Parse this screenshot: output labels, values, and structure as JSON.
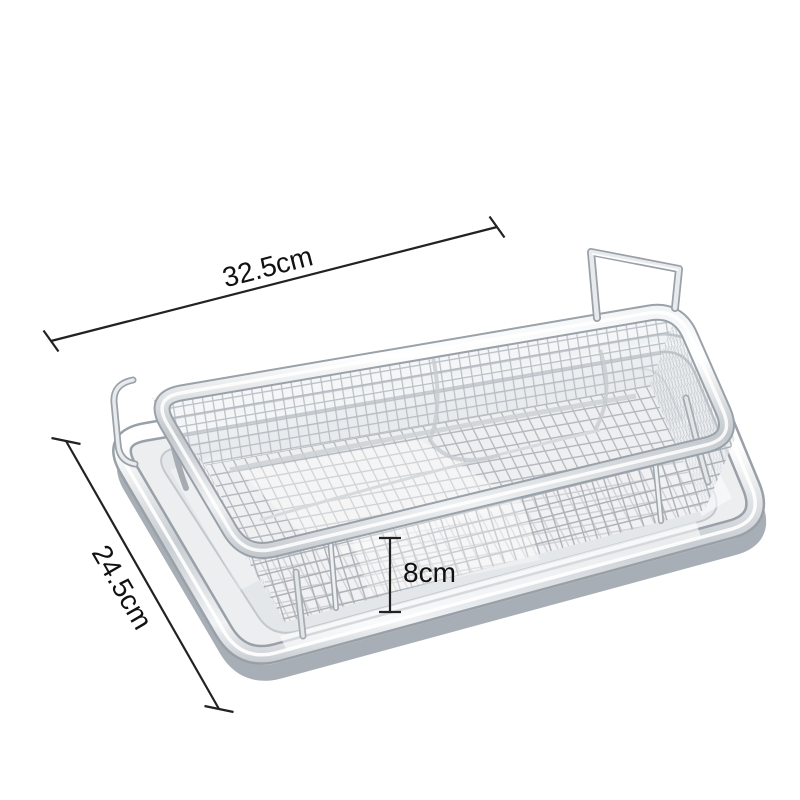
{
  "dimensions": {
    "width": "32.5cm",
    "depth": "24.5cm",
    "height": "8cm"
  },
  "colors": {
    "background": "#ffffff",
    "metal_highlight": "#fbfcfd",
    "metal_mid": "#cfd4d8",
    "metal_shadow": "#9aa1a8",
    "mesh_line": "#aeb4ba",
    "annotation_line": "#222222",
    "annotation_text": "#111111"
  }
}
